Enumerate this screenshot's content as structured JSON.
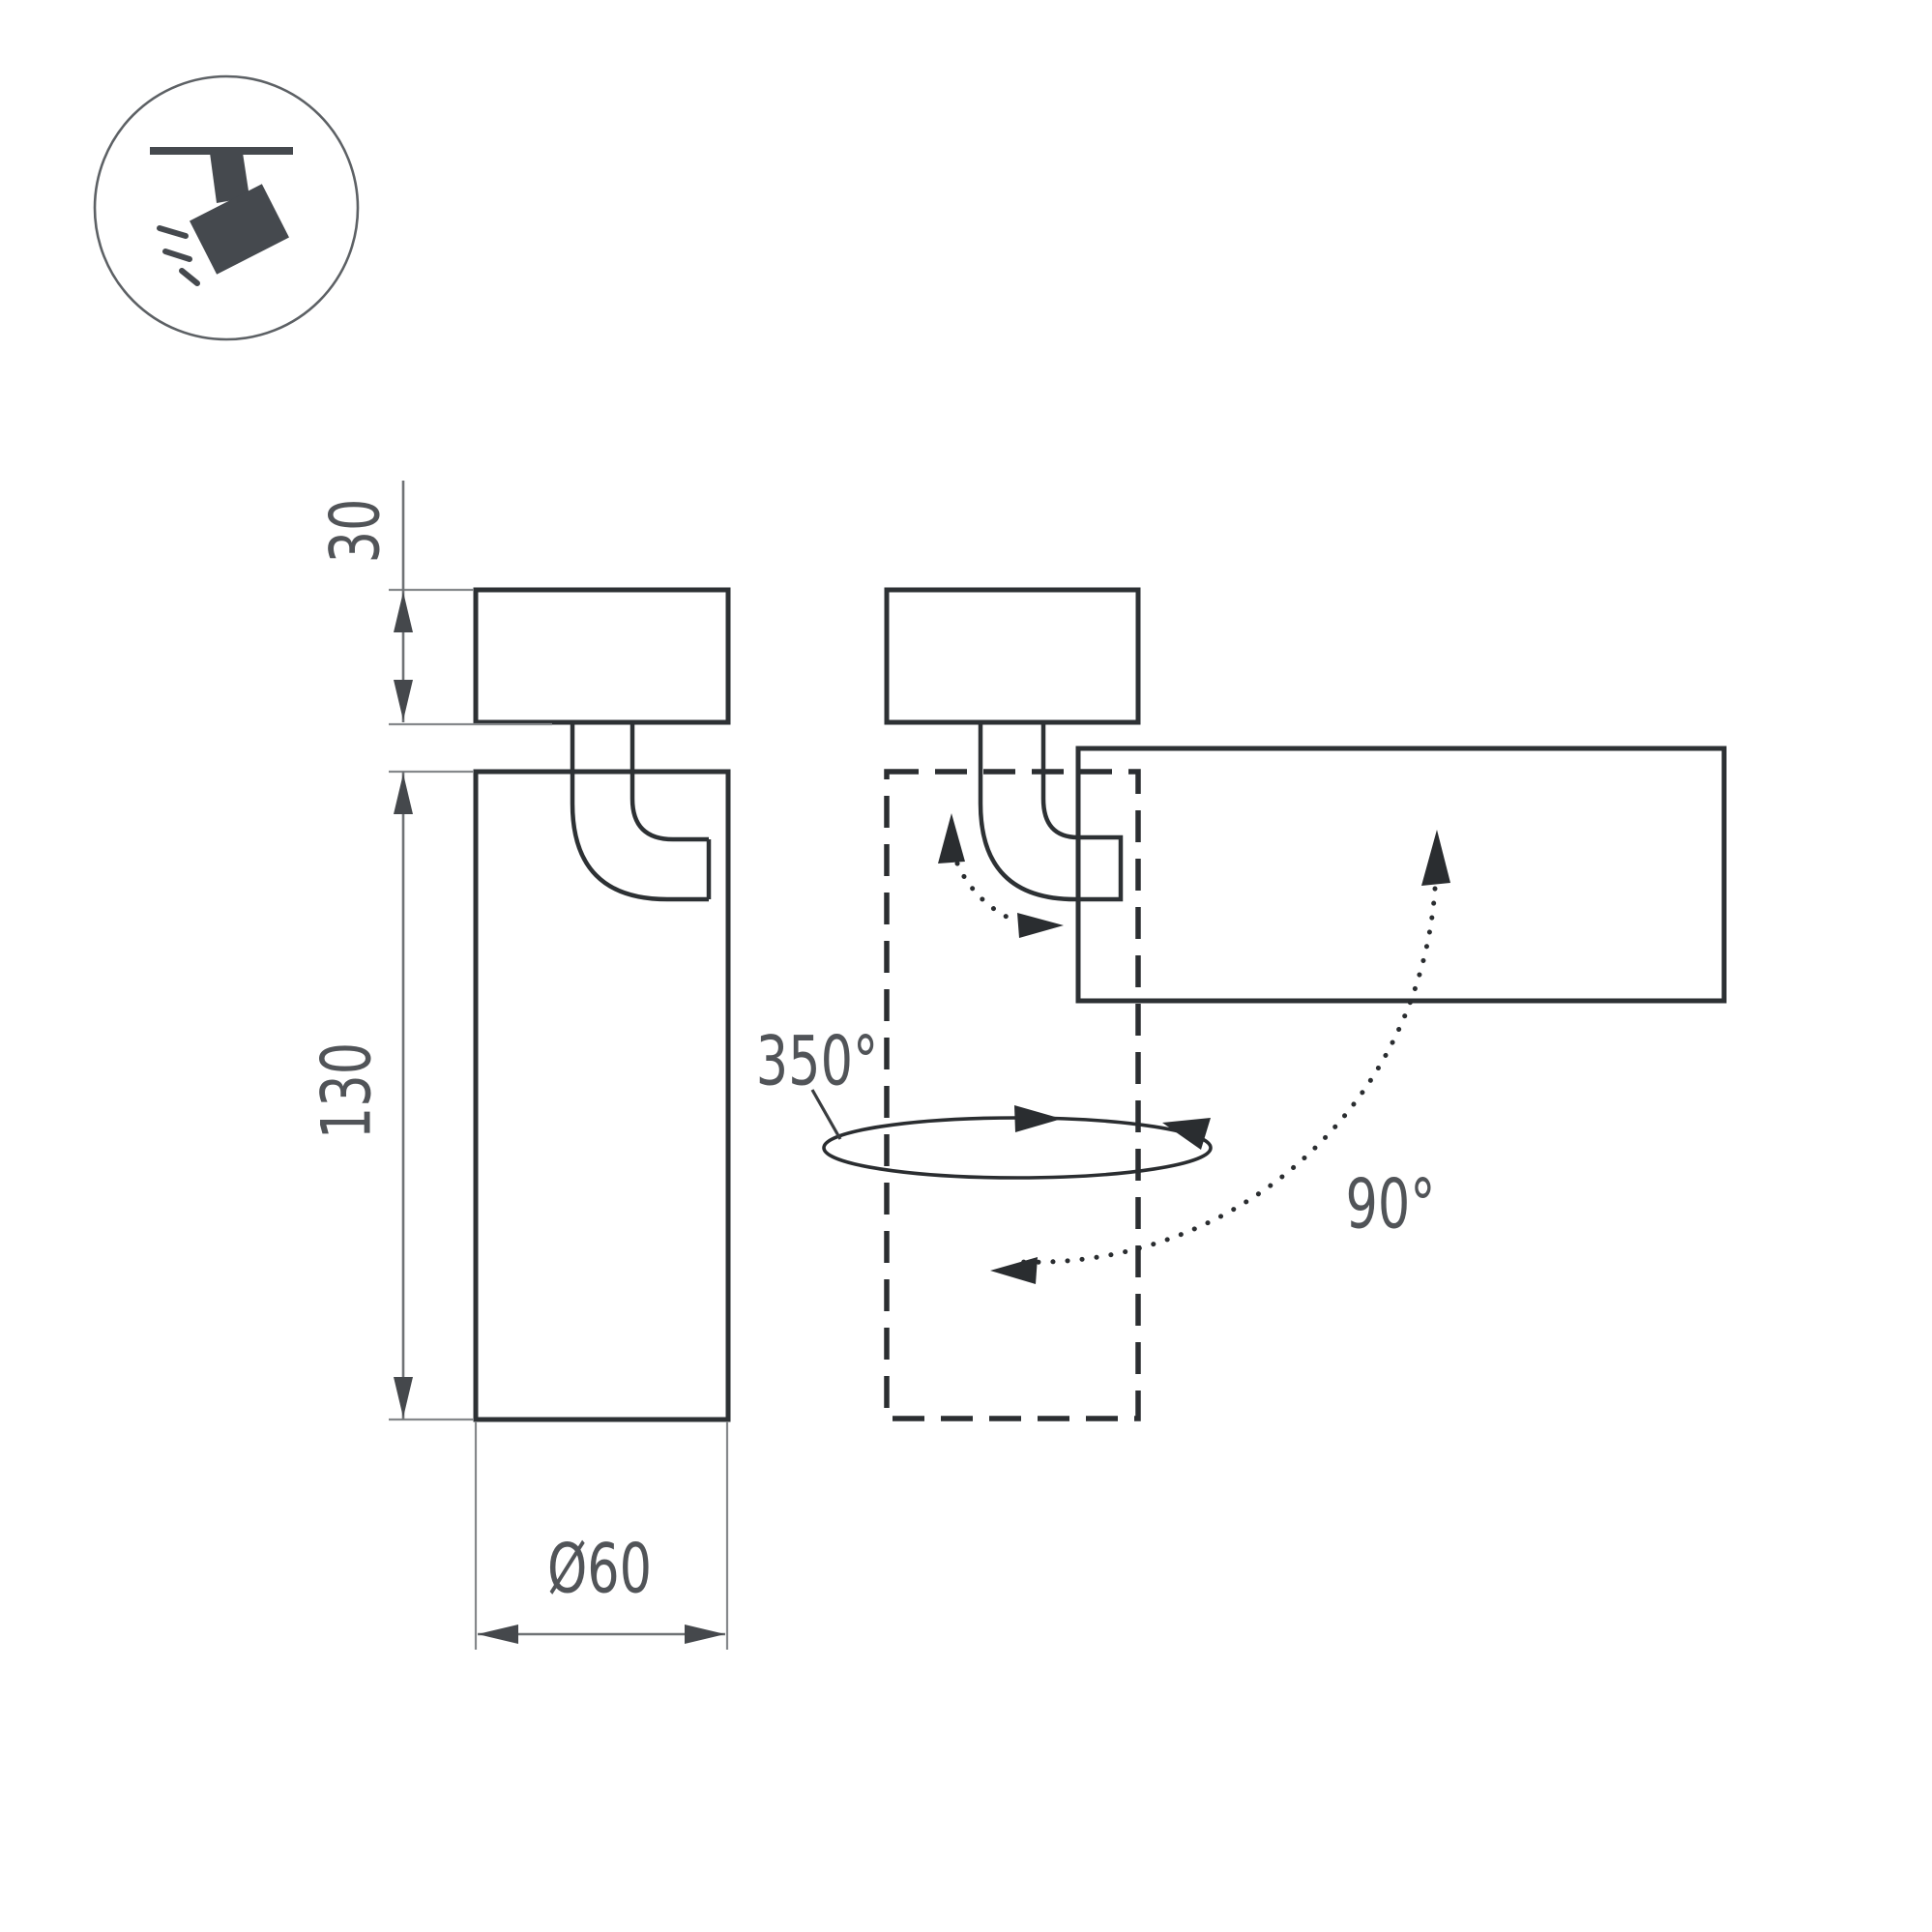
{
  "icon": {
    "name": "ceiling-track-spotlight-pictogram"
  },
  "dimensions": {
    "cap_height": "30",
    "body_height": "130",
    "body_diameter": "Ø60"
  },
  "rotation": {
    "swivel_angle": "350°",
    "tilt_angle": "90°"
  },
  "colors": {
    "background": "#ffffff",
    "outline_ink": "#2d3134",
    "dim_line": "#85888b",
    "label_text": "#515458",
    "icon_fill": "#45494e"
  }
}
